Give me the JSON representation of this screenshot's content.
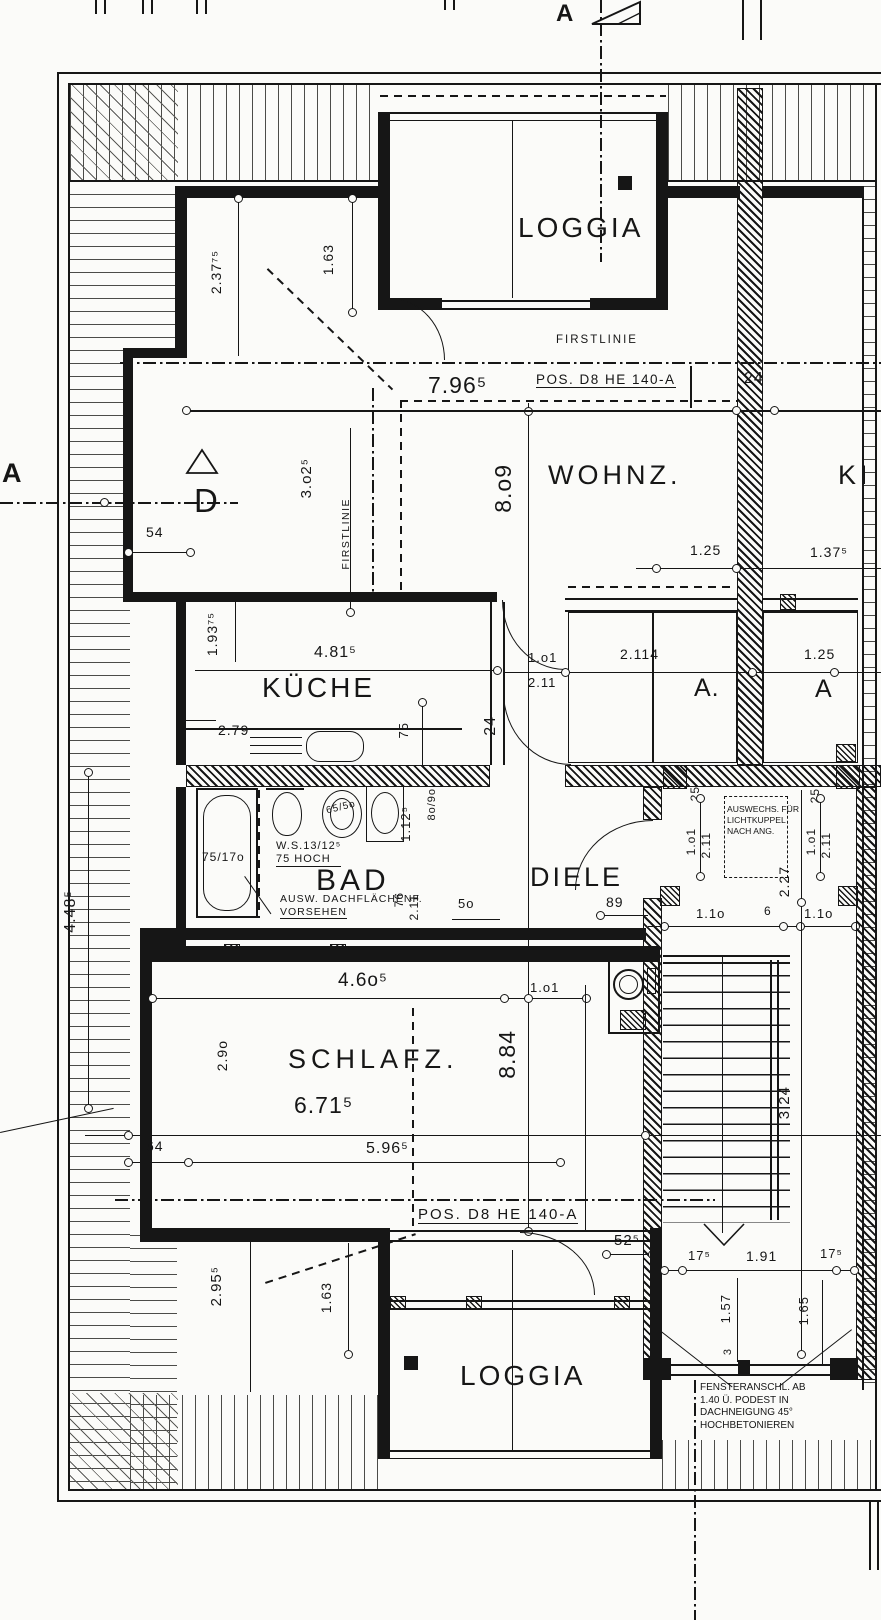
{
  "rooms": {
    "loggia_top": "LOGGIA",
    "wohnz": "WOHNZ.",
    "ki": "KI",
    "kueche": "KÜCHE",
    "bad": "BAD",
    "diele": "DIELE",
    "a_dot": "A.",
    "a_plain": "A",
    "schlafz": "SCHLAFZ.",
    "loggia_bottom": "LOGGIA"
  },
  "labels": {
    "firstlinie_top": "FIRSTLINIE",
    "firstlinie_left": "FIRSTLINIE",
    "pos_top": "POS. D8 HE 140-A",
    "pos_bottom": "POS. D8 HE  140-A",
    "section_d": "D",
    "section_a_left": "A",
    "section_a_top": "A"
  },
  "notes": {
    "ws_1": "W.S.13/12⁵",
    "ws_2": "75 HOCH",
    "dach_1": "AUSW. DACHFLÄCHENF.",
    "dach_2": "VORSEHEN",
    "auswechs_1": "AUSWECHS. FÜR",
    "auswechs_2": "LICHTKUPPEL",
    "auswechs_3": "NACH ANG.",
    "fenster_1": "FENSTERANSCHL. AB",
    "fenster_2": "1.40 Ü. PODEST IN",
    "fenster_3": "DACHNEIGUNG 45°",
    "fenster_4": "HOCHBETONIEREN"
  },
  "dims": {
    "d796": "7.96⁵",
    "d24_top": "24",
    "d809": "8.o9",
    "d23775": "2.37⁷⁵",
    "d163_top": "1.63",
    "d302": "3.o2⁵",
    "d54": "54",
    "d125_r1": "1.25",
    "d1375": "1.37⁵",
    "d19375": "1.93⁷⁵",
    "d481": "4.81⁵",
    "d1o1_k": "1.o1",
    "d211_k": "2.11",
    "d2114": "2.114",
    "d125_r2": "1.25",
    "d279": "2.79",
    "d75": "75",
    "d24_mid": "24",
    "d7517o": "75/17o",
    "d655o": "65/5o",
    "d8o9o": "8o/9o",
    "d1125": "1.12⁵",
    "d76": "76",
    "d211_b": "2.11",
    "d5o": "5o",
    "d89": "89",
    "d25_l": "25",
    "d25_r": "25",
    "d1o1_l": "1.o1",
    "d211_l": "2.11",
    "d1o1_r": "1.o1",
    "d211_r": "2.11",
    "d227": "2.27",
    "d11o_a": "1.1o",
    "d6": "6",
    "d11o_b": "1.1o",
    "d46o": "4.6o⁵",
    "d1o1_s": "1.o1",
    "d29o": "2.9o",
    "d884": "8.84",
    "d671": "6.71⁵",
    "d448": "4.48⁵",
    "d64": "64",
    "d596": "5.96⁵",
    "d295": "2.95⁵",
    "d163_b": "1.63",
    "d525": "52⁵",
    "d175_l": "17⁵",
    "d191": "1.91",
    "d175_r": "17⁵",
    "d157": "1.57",
    "d165": "1.65",
    "d3": "3",
    "d324": "3.24"
  }
}
